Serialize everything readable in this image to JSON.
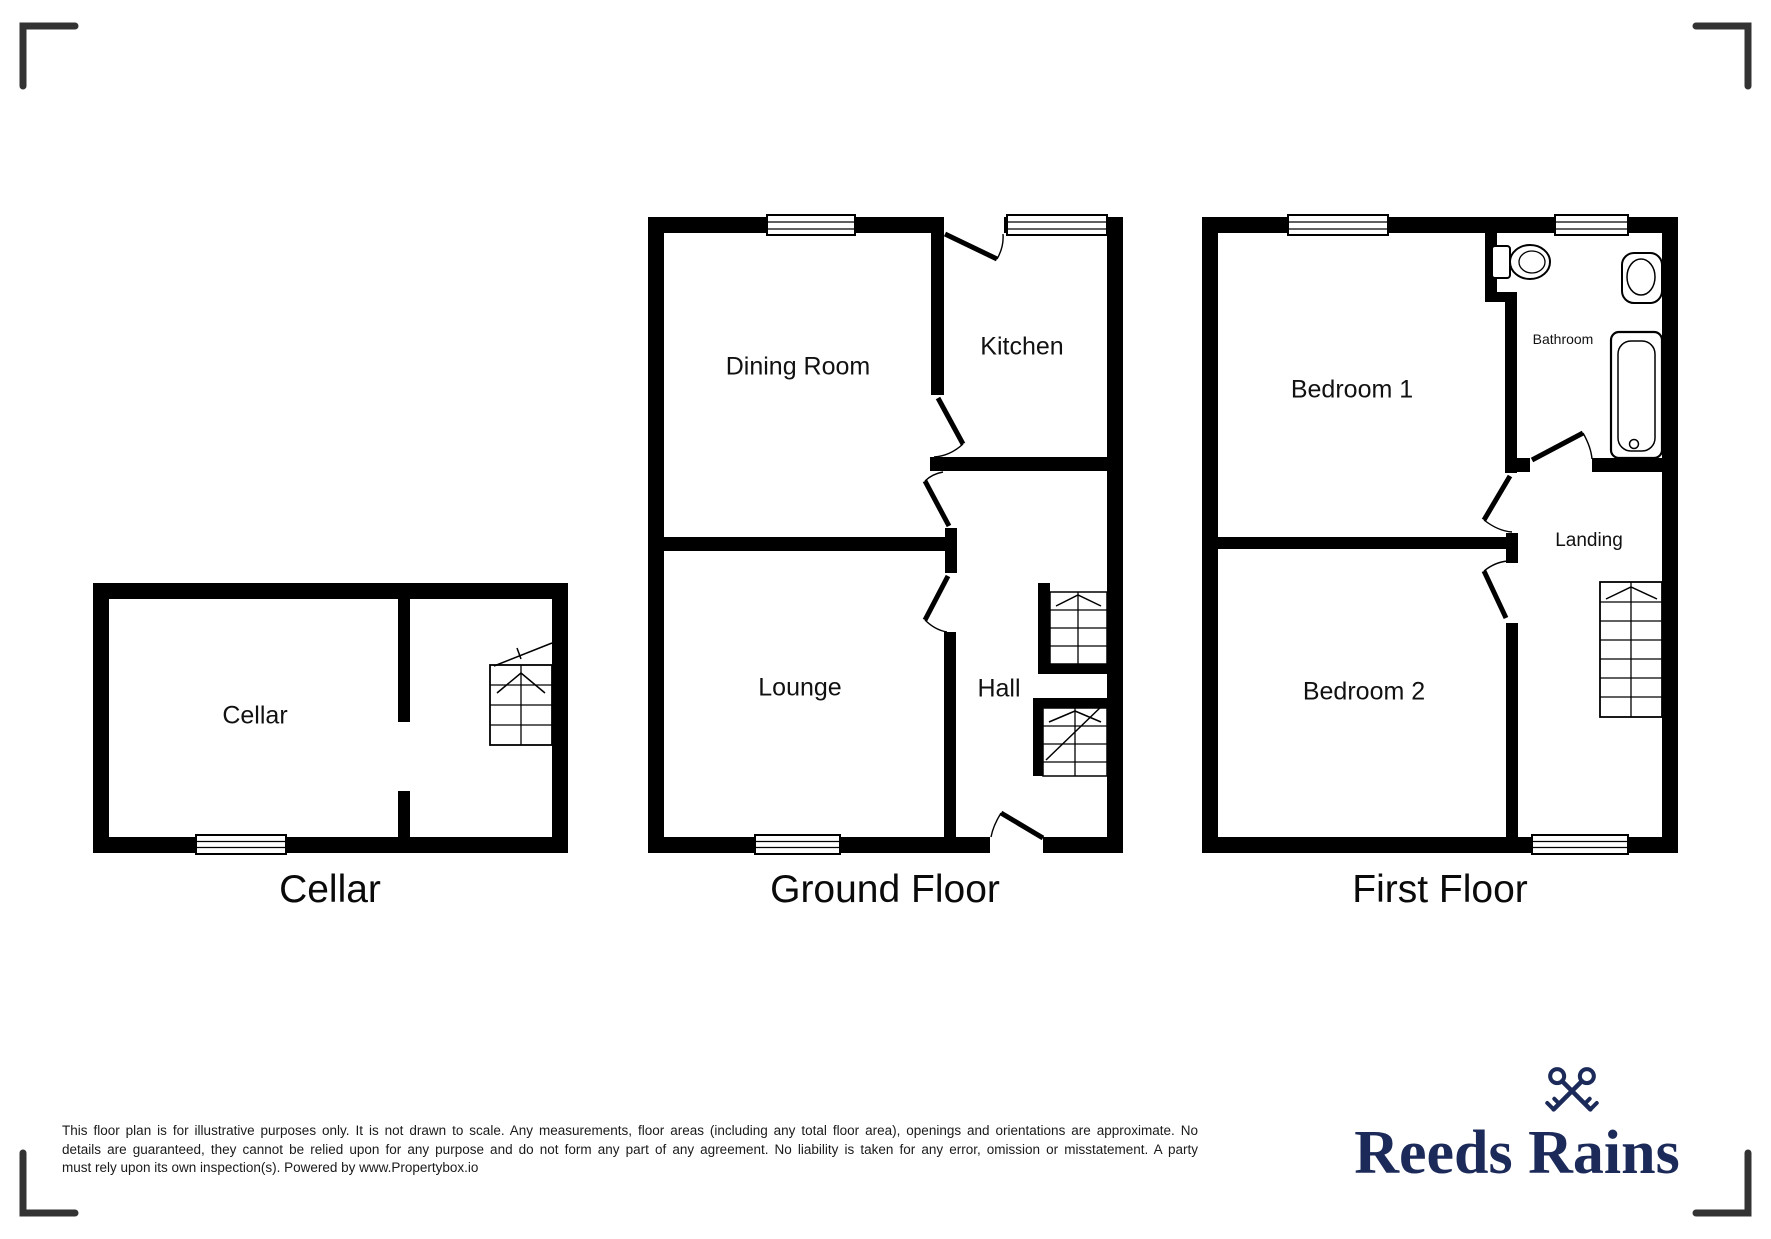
{
  "plans": {
    "cellar": {
      "caption": "Cellar",
      "rooms": {
        "cellar": "Cellar"
      }
    },
    "ground_floor": {
      "caption": "Ground Floor",
      "rooms": {
        "dining_room": "Dining Room",
        "kitchen": "Kitchen",
        "lounge": "Lounge",
        "hall": "Hall"
      }
    },
    "first_floor": {
      "caption": "First Floor",
      "rooms": {
        "bedroom1": "Bedroom 1",
        "bathroom": "Bathroom",
        "bedroom2": "Bedroom 2",
        "landing": "Landing"
      }
    }
  },
  "fixtures": {
    "toilet": "toilet-icon",
    "sink": "sink-icon",
    "bathtub": "bathtub-icon",
    "stairs": "stairs-icon",
    "window": "window-icon",
    "door": "door-swing-icon"
  },
  "disclaimer": {
    "line1": "This floor plan is for illustrative purposes only. It is not drawn to scale. Any measurements, floor areas (including any total floor area), openings and orientations are approximate. No",
    "line2": "details are guaranteed, they cannot be relied upon for any purpose and do not form any part of any agreement. No liability is taken for any error, omission or misstatement. A party",
    "line3": "must rely upon its own inspection(s). Powered by www.Propertybox.io"
  },
  "logo": {
    "brand": "Reeds Rains",
    "icon": "crossed-keys-icon",
    "color": "#1c2a59"
  },
  "colors": {
    "wall": "#000000",
    "bracket": "#333333",
    "text": "#111111"
  }
}
